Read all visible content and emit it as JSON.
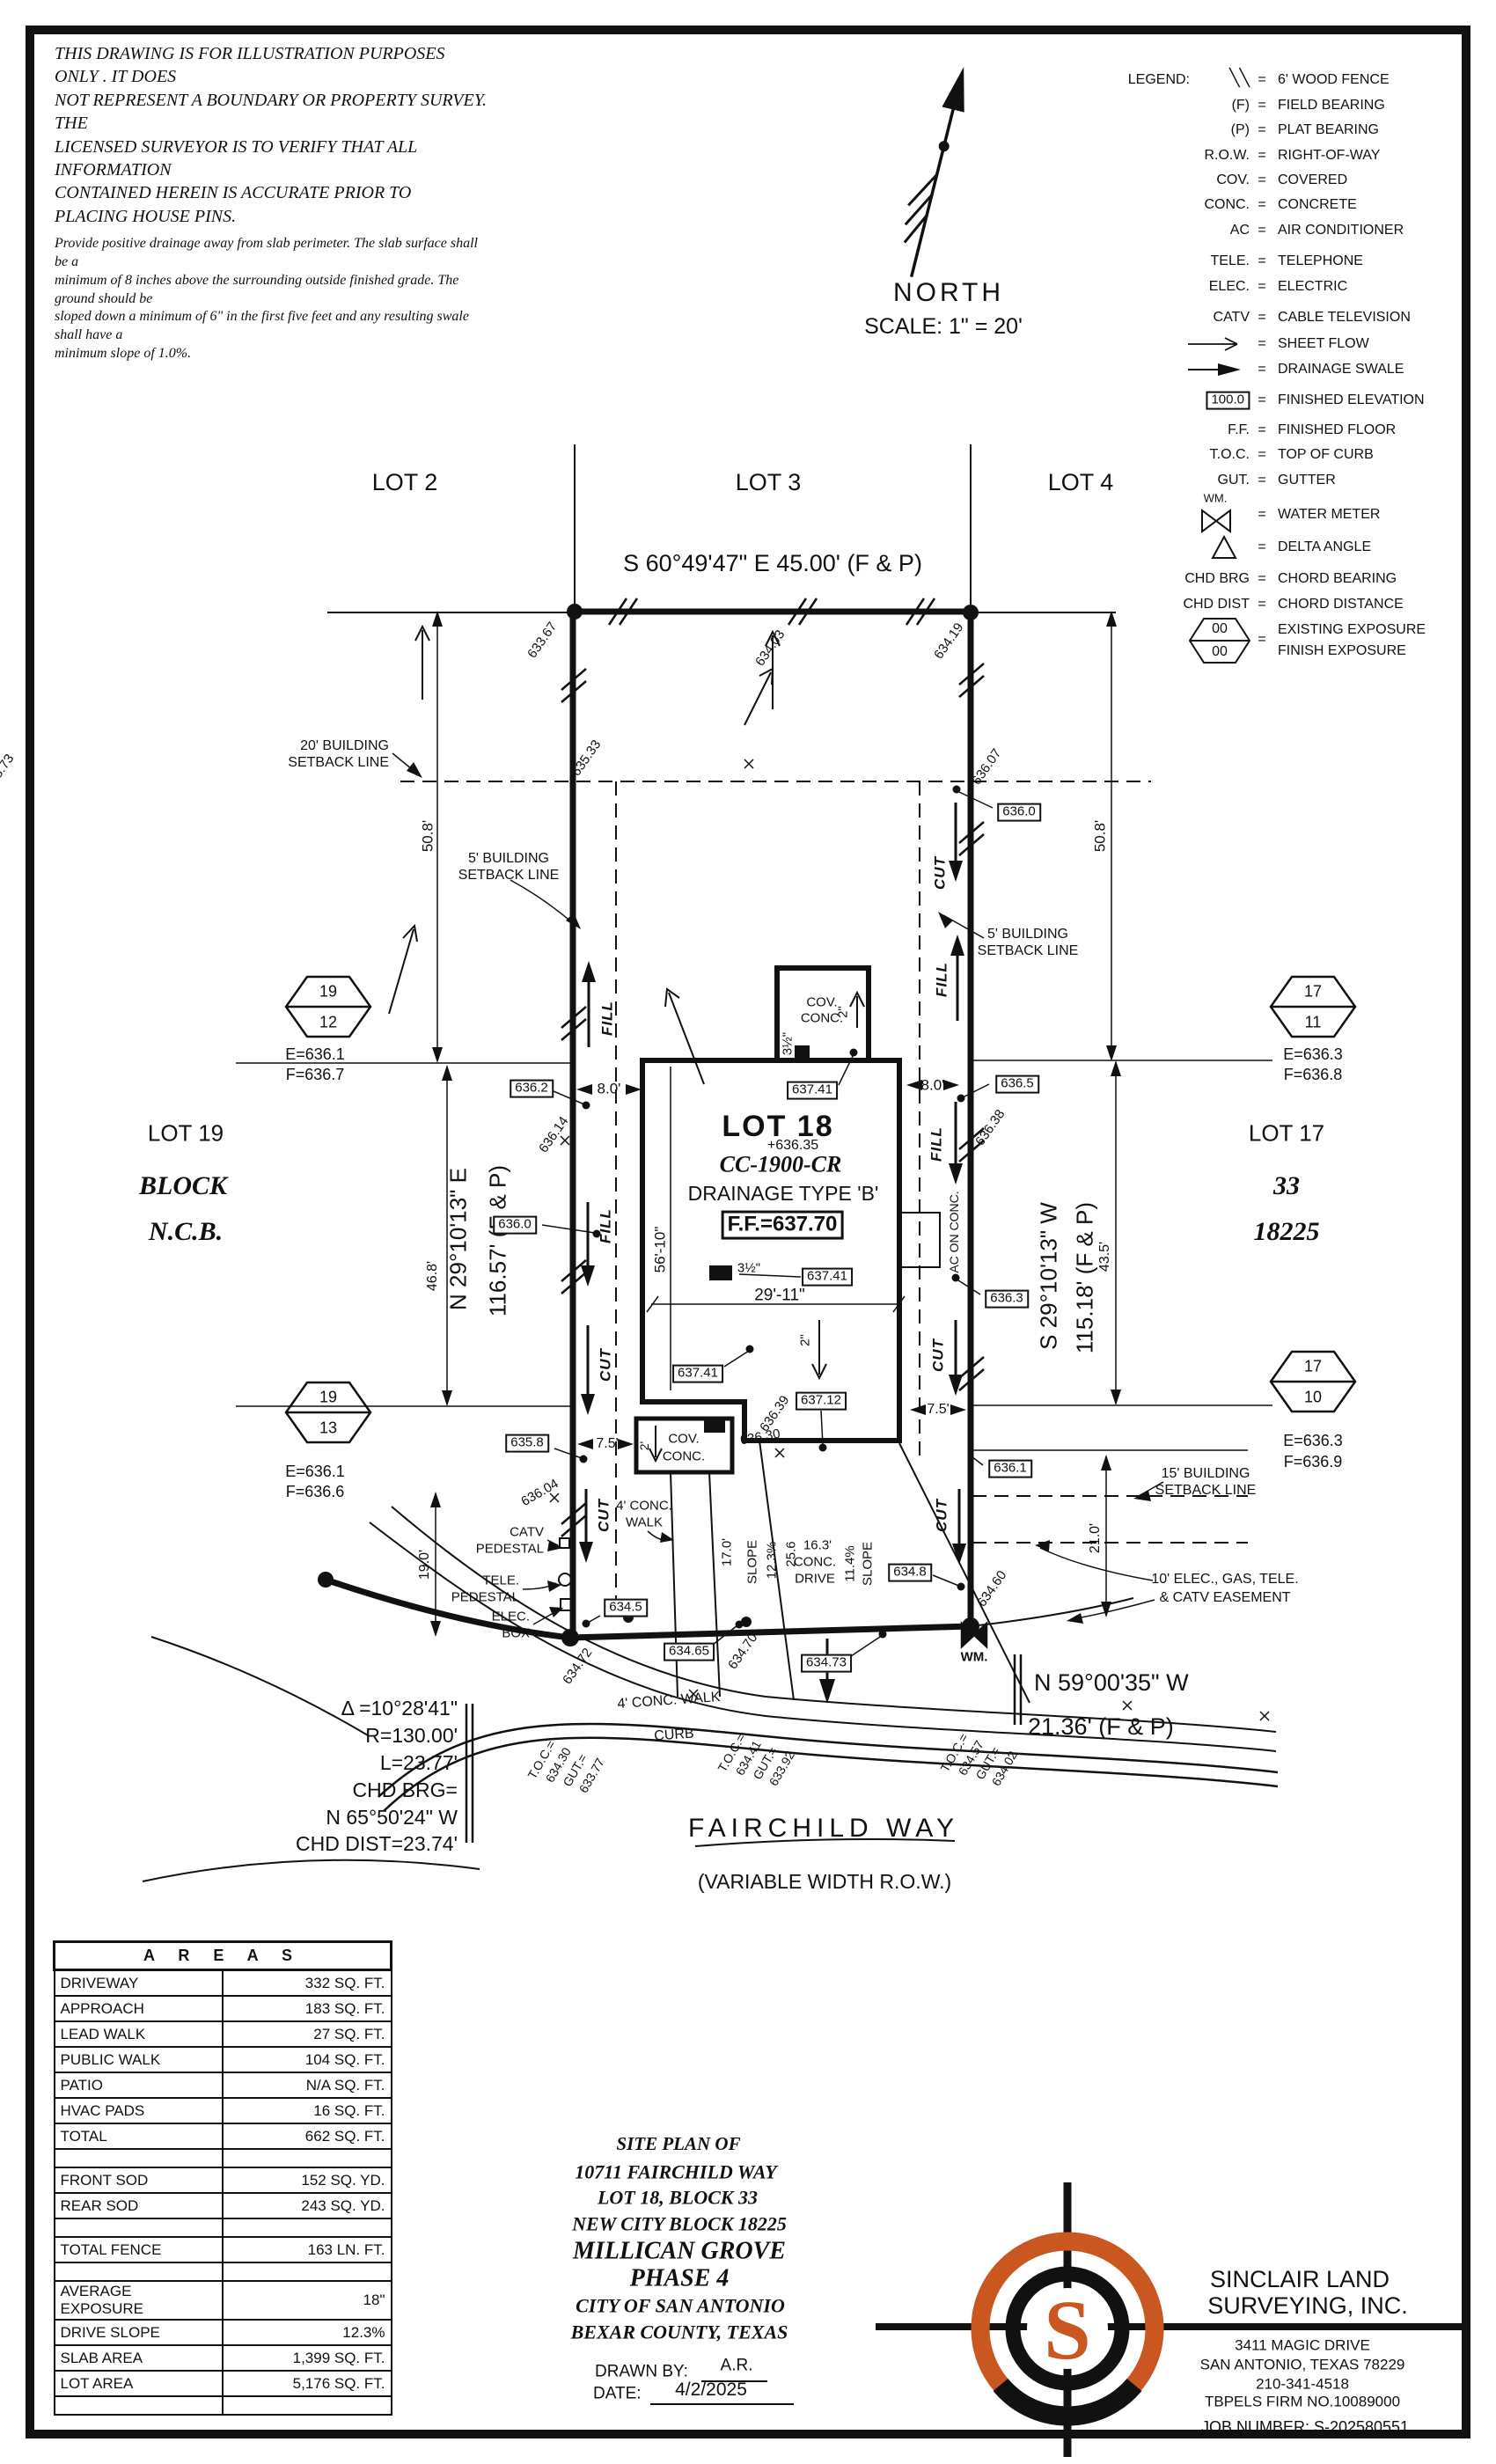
{
  "colors": {
    "ink": "#111111",
    "paper": "#ffffff",
    "logo_orange": "#c9571f"
  },
  "disclaimer": {
    "lines": [
      "THIS DRAWING IS FOR ILLUSTRATION PURPOSES ONLY . IT DOES",
      "NOT REPRESENT A BOUNDARY OR PROPERTY SURVEY. THE",
      "LICENSED SURVEYOR IS TO VERIFY THAT ALL INFORMATION",
      "CONTAINED HEREIN IS ACCURATE PRIOR TO PLACING HOUSE PINS."
    ],
    "note_lines": [
      "Provide positive drainage away from slab perimeter. The slab surface shall be a",
      "minimum of 8 inches above the surrounding outside finished grade. The ground should be",
      "sloped down a minimum of 6\" in the first five feet and any resulting swale shall have a",
      "minimum slope of 1.0%."
    ]
  },
  "compass": {
    "label": "NORTH",
    "scale": "SCALE:  1\"  =  20'"
  },
  "legend": {
    "title": "LEGEND:",
    "eq": "=",
    "items": [
      {
        "sym": "╲╲",
        "desc": "6' WOOD FENCE"
      },
      {
        "sym": "(F)",
        "desc": "FIELD BEARING"
      },
      {
        "sym": "(P)",
        "desc": "PLAT BEARING"
      },
      {
        "sym": "R.O.W.",
        "desc": "RIGHT-OF-WAY"
      },
      {
        "sym": "COV.",
        "desc": "COVERED"
      },
      {
        "sym": "CONC.",
        "desc": "CONCRETE"
      },
      {
        "sym": "AC",
        "desc": "AIR CONDITIONER"
      },
      {
        "sym": "TELE.",
        "desc": "TELEPHONE"
      },
      {
        "sym": "ELEC.",
        "desc": "ELECTRIC"
      },
      {
        "sym": "CATV",
        "desc": "CABLE TELEVISION"
      },
      {
        "icon": "sheet-flow-arrow-icon",
        "desc": "SHEET FLOW"
      },
      {
        "icon": "drainage-swale-arrow-icon",
        "desc": "DRAINAGE SWALE"
      },
      {
        "sym": "100.0",
        "desc": "FINISHED ELEVATION"
      },
      {
        "sym": "F.F.",
        "desc": "FINISHED FLOOR"
      },
      {
        "sym": "T.O.C.",
        "desc": "TOP OF CURB"
      },
      {
        "sym": "GUT.",
        "desc": "GUTTER"
      },
      {
        "sym": "WM.",
        "icon": "water-meter-icon",
        "desc": "WATER METER"
      },
      {
        "icon": "delta-angle-icon",
        "desc": "DELTA ANGLE"
      },
      {
        "sym": "CHD BRG",
        "desc": "CHORD BEARING"
      },
      {
        "sym": "CHD DIST",
        "desc": "CHORD DISTANCE"
      },
      {
        "sym_top": "00",
        "sym_bottom": "00",
        "icon": "exposure-hexagon-icon",
        "desc": "EXISTING EXPOSURE",
        "desc2": "FINISH EXPOSURE"
      }
    ]
  },
  "adjacent_lots": {
    "top": [
      "LOT 2",
      "LOT 3",
      "LOT 4"
    ],
    "left": {
      "lot": "LOT 19",
      "block": "BLOCK",
      "ncb": "N.C.B."
    },
    "right": {
      "lot": "LOT 17",
      "block": "33",
      "ncb": "18225"
    }
  },
  "boundary": {
    "north_bearing": "S 60°49'47\" E  45.00'  (F & P)",
    "west_bearing": "N 29°10'13\" E",
    "west_distance": "116.57'  (F & P)",
    "east_bearing": "S 29°10'13\" W",
    "east_distance": "115.18'  (F & P)",
    "south_bearing": "N  59°00'35\"  W",
    "south_distance": "21.36'  (F & P)"
  },
  "curve": {
    "delta": "Δ =10°28'41\"",
    "radius": "R=130.00'",
    "length": "L=23.77'",
    "chb_label": "CHD BRG=",
    "chord_bearing": "N 65°50'24\" W",
    "chord_dist": "CHD DIST=23.74'"
  },
  "corner_markers": [
    {
      "top": "19",
      "bottom": "12",
      "e": "E=636.1",
      "f": "F=636.7"
    },
    {
      "top": "19",
      "bottom": "13",
      "e": "E=636.1",
      "f": "F=636.6"
    },
    {
      "top": "17",
      "bottom": "11",
      "e": "E=636.3",
      "f": "F=636.8"
    },
    {
      "top": "17",
      "bottom": "10",
      "e": "E=636.3",
      "f": "F=636.9"
    }
  ],
  "house": {
    "lot": "LOT 18",
    "spot": "+636.35",
    "plan_code": "CC-1900-CR",
    "drainage": "DRAINAGE TYPE 'B'",
    "ff": "F.F.=637.70",
    "cov": "COV.",
    "conc": "CONC.",
    "ac": "AC ON CONC."
  },
  "boxes": {
    "tr": "636.0",
    "l1": "636.2",
    "r1": "636.5",
    "l2": "636.0",
    "r2": "636.3",
    "l3": "635.8",
    "r3": "636.1",
    "h1": "637.41",
    "h2": "637.41",
    "h3": "637.41",
    "h4": "637.12",
    "s1": "634.5",
    "s2": "634.65",
    "s3": "634.73",
    "s4": "634.8"
  },
  "spots": [
    "633.67",
    "634.03",
    "634.19",
    "635.33",
    "635.73",
    "636.07",
    "636.14",
    "636.38",
    "636.39",
    "636.30",
    "636.04",
    "634.60",
    "634.72",
    "634.70"
  ],
  "dims": {
    "d50l": "50.8'",
    "d50r": "50.8'",
    "d8l": "8.0'",
    "d8r": "8.0'",
    "d46": "46.8'",
    "d43": "43.5'",
    "d56": "56'-10\"",
    "d29": "29'-11\"",
    "d7l": "7.5'",
    "d7r": "7.5'",
    "d2p": "2'",
    "d19": "19.0'",
    "d21": "21.0'",
    "d17": "17.0'",
    "d25": "25.6",
    "d16": "16.3'",
    "conc": "CONC.",
    "drive": "DRIVE",
    "slope": "SLOPE",
    "pct1": "12.3%",
    "pct2": "11.4%",
    "d3a": "3½\"",
    "d3b": "3½\"",
    "d2a": "2\"",
    "d2b": "2\""
  },
  "setbacks": {
    "s20a": "20' BUILDING",
    "s20b": "SETBACK LINE",
    "s5la": "5' BUILDING",
    "s5lb": "SETBACK LINE",
    "s5ra": "5' BUILDING",
    "s5rb": "SETBACK LINE",
    "s15a": "15' BUILDING",
    "s15b": "SETBACK LINE",
    "ease1": "10' ELEC., GAS, TELE.",
    "ease2": "& CATV EASEMENT"
  },
  "utilities": {
    "catv1": "CATV",
    "catv2": "PEDESTAL",
    "tele1": "TELE.",
    "tele2": "PEDESTAL",
    "elec1": "ELEC.",
    "elec2": "BOX",
    "wm": "WM."
  },
  "street": {
    "name": "FAIRCHILD  WAY",
    "row": "(VARIABLE  WIDTH  R.O.W.)",
    "walk": "4'  CONC.  WALK",
    "walk2a": "4'  CONC.",
    "walk2b": "WALK",
    "curb": "CURB"
  },
  "toc": {
    "left": [
      "T.O.C.=",
      "634.30",
      "GUT.=",
      "633.77"
    ],
    "center": [
      "T.O.C.=",
      "634.41",
      "GUT.=",
      "633.92"
    ],
    "right": [
      "T.O.C.=",
      "634.57",
      "GUT.=",
      "634.02"
    ]
  },
  "flow": {
    "fill": "FILL",
    "cut": "CUT"
  },
  "areas_table": {
    "header": "A R E A S",
    "rows": [
      {
        "label": "DRIVEWAY",
        "value": "332 SQ. FT."
      },
      {
        "label": "APPROACH",
        "value": "183 SQ. FT."
      },
      {
        "label": "LEAD WALK",
        "value": "27 SQ. FT."
      },
      {
        "label": "PUBLIC WALK",
        "value": "104 SQ. FT."
      },
      {
        "label": "PATIO",
        "value": "N/A SQ. FT."
      },
      {
        "label": "HVAC PADS",
        "value": "16 SQ. FT."
      },
      {
        "label": "TOTAL",
        "value": "662 SQ. FT."
      },
      {
        "label": "",
        "value": ""
      },
      {
        "label": "FRONT SOD",
        "value": "152 SQ. YD."
      },
      {
        "label": "REAR SOD",
        "value": "243 SQ. YD."
      },
      {
        "label": "",
        "value": ""
      },
      {
        "label": "TOTAL FENCE",
        "value": "163 LN. FT."
      },
      {
        "label": "",
        "value": ""
      },
      {
        "label": "AVERAGE EXPOSURE",
        "value": "18\""
      },
      {
        "label": "DRIVE SLOPE",
        "value": "12.3%"
      },
      {
        "label": "SLAB AREA",
        "value": "1,399 SQ. FT."
      },
      {
        "label": "LOT AREA",
        "value": "5,176 SQ. FT."
      },
      {
        "label": "",
        "value": ""
      }
    ]
  },
  "title_block": {
    "l1": "SITE  PLAN  OF",
    "l2": "10711  FAIRCHILD  WAY",
    "l3": "LOT  18,  BLOCK  33",
    "l4": "NEW  CITY  BLOCK  18225",
    "subdivision": "MILLICAN  GROVE",
    "phase": "PHASE  4",
    "city": "CITY  OF  SAN  ANTONIO",
    "county": "BEXAR  COUNTY,  TEXAS",
    "drawn_by_label": "DRAWN  BY:",
    "drawn_by": "A.R.",
    "date_label": "DATE:",
    "date": "4/2/2025"
  },
  "firm": {
    "name1": "SINCLAIR  LAND",
    "name2": "SURVEYING,  INC.",
    "address1": "3411  MAGIC  DRIVE",
    "address2": "SAN  ANTONIO,  TEXAS  78229",
    "phone": "210-341-4518",
    "tbpels": "TBPELS  FIRM  NO.10089000",
    "job": "JOB  NUMBER:    S-202580551",
    "logo_letter": "S"
  }
}
